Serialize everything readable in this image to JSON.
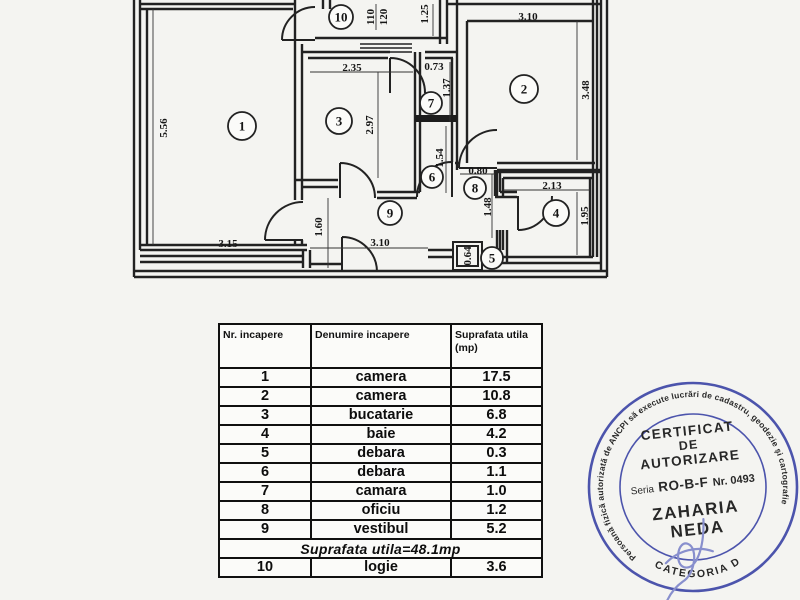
{
  "document": {
    "background": "#f4f4f1",
    "ink": "#1f1f1f"
  },
  "floorplan": {
    "rooms": [
      {
        "num": "1",
        "x": 242,
        "y": 126,
        "r": 14
      },
      {
        "num": "2",
        "x": 524,
        "y": 89,
        "r": 14
      },
      {
        "num": "3",
        "x": 339,
        "y": 121,
        "r": 13
      },
      {
        "num": "4",
        "x": 556,
        "y": 213,
        "r": 13
      },
      {
        "num": "5",
        "x": 492,
        "y": 258,
        "r": 11
      },
      {
        "num": "6",
        "x": 432,
        "y": 177,
        "r": 11
      },
      {
        "num": "7",
        "x": 431,
        "y": 103,
        "r": 11
      },
      {
        "num": "8",
        "x": 475,
        "y": 188,
        "r": 11
      },
      {
        "num": "9",
        "x": 390,
        "y": 213,
        "r": 12
      },
      {
        "num": "10",
        "x": 341,
        "y": 17,
        "r": 12
      }
    ],
    "dimensions": [
      {
        "text": "5.56",
        "x": 163,
        "y": 128,
        "rot": -90
      },
      {
        "text": "3.15",
        "x": 228,
        "y": 243,
        "rot": 0
      },
      {
        "text": "110",
        "x": 370,
        "y": 17,
        "rot": -90
      },
      {
        "text": "120",
        "x": 383,
        "y": 17,
        "rot": -90
      },
      {
        "text": "1.25",
        "x": 424,
        "y": 14,
        "rot": -90
      },
      {
        "text": "3.10",
        "x": 528,
        "y": 16,
        "rot": 0
      },
      {
        "text": "3.48",
        "x": 585,
        "y": 90,
        "rot": -90
      },
      {
        "text": "2.35",
        "x": 352,
        "y": 67,
        "rot": 0
      },
      {
        "text": "0.73",
        "x": 434,
        "y": 66,
        "rot": 0
      },
      {
        "text": "1.37",
        "x": 446,
        "y": 88,
        "rot": -90
      },
      {
        "text": "2.97",
        "x": 369,
        "y": 125,
        "rot": -90
      },
      {
        "text": "1.54",
        "x": 439,
        "y": 158,
        "rot": -90
      },
      {
        "text": "0.80",
        "x": 478,
        "y": 170,
        "rot": 0
      },
      {
        "text": "1.48",
        "x": 487,
        "y": 207,
        "rot": -90
      },
      {
        "text": "2.13",
        "x": 552,
        "y": 185,
        "rot": 0
      },
      {
        "text": "1.95",
        "x": 584,
        "y": 216,
        "rot": -90
      },
      {
        "text": "0.64",
        "x": 467,
        "y": 256,
        "rot": -90
      },
      {
        "text": "1.60",
        "x": 318,
        "y": 227,
        "rot": -90
      },
      {
        "text": "3.10",
        "x": 380,
        "y": 242,
        "rot": 0
      }
    ]
  },
  "table": {
    "headers": [
      "Nr. incapere",
      "Denumire incapere",
      "Suprafata utila\n(mp)"
    ],
    "rows": [
      [
        "1",
        "camera",
        "17.5"
      ],
      [
        "2",
        "camera",
        "10.8"
      ],
      [
        "3",
        "bucatarie",
        "6.8"
      ],
      [
        "4",
        "baie",
        "4.2"
      ],
      [
        "5",
        "debara",
        "0.3"
      ],
      [
        "6",
        "debara",
        "1.1"
      ],
      [
        "7",
        "camara",
        "1.0"
      ],
      [
        "8",
        "oficiu",
        "1.2"
      ],
      [
        "9",
        "vestibul",
        "5.2"
      ]
    ],
    "summary": "Suprafata utila=48.1mp",
    "extra_rows": [
      [
        "10",
        "logie",
        "3.6"
      ]
    ]
  },
  "stamp": {
    "color": "#3e47a7",
    "signature_color": "#7f87cb",
    "ring_text": "Persoană fizică autorizată de ANCPI să execute lucrări de cadastru, geodezie şi cartografie",
    "cert_line1": "CERTIFICAT",
    "cert_line2": "DE",
    "cert_line3": "AUTORIZARE",
    "seria_label": "Seria",
    "seria_value": "RO-B-F",
    "nr_value": "Nr. 0493",
    "name_line1": "ZAHARIA",
    "name_line2": "NEDA",
    "category": "CATEGORIA D"
  }
}
